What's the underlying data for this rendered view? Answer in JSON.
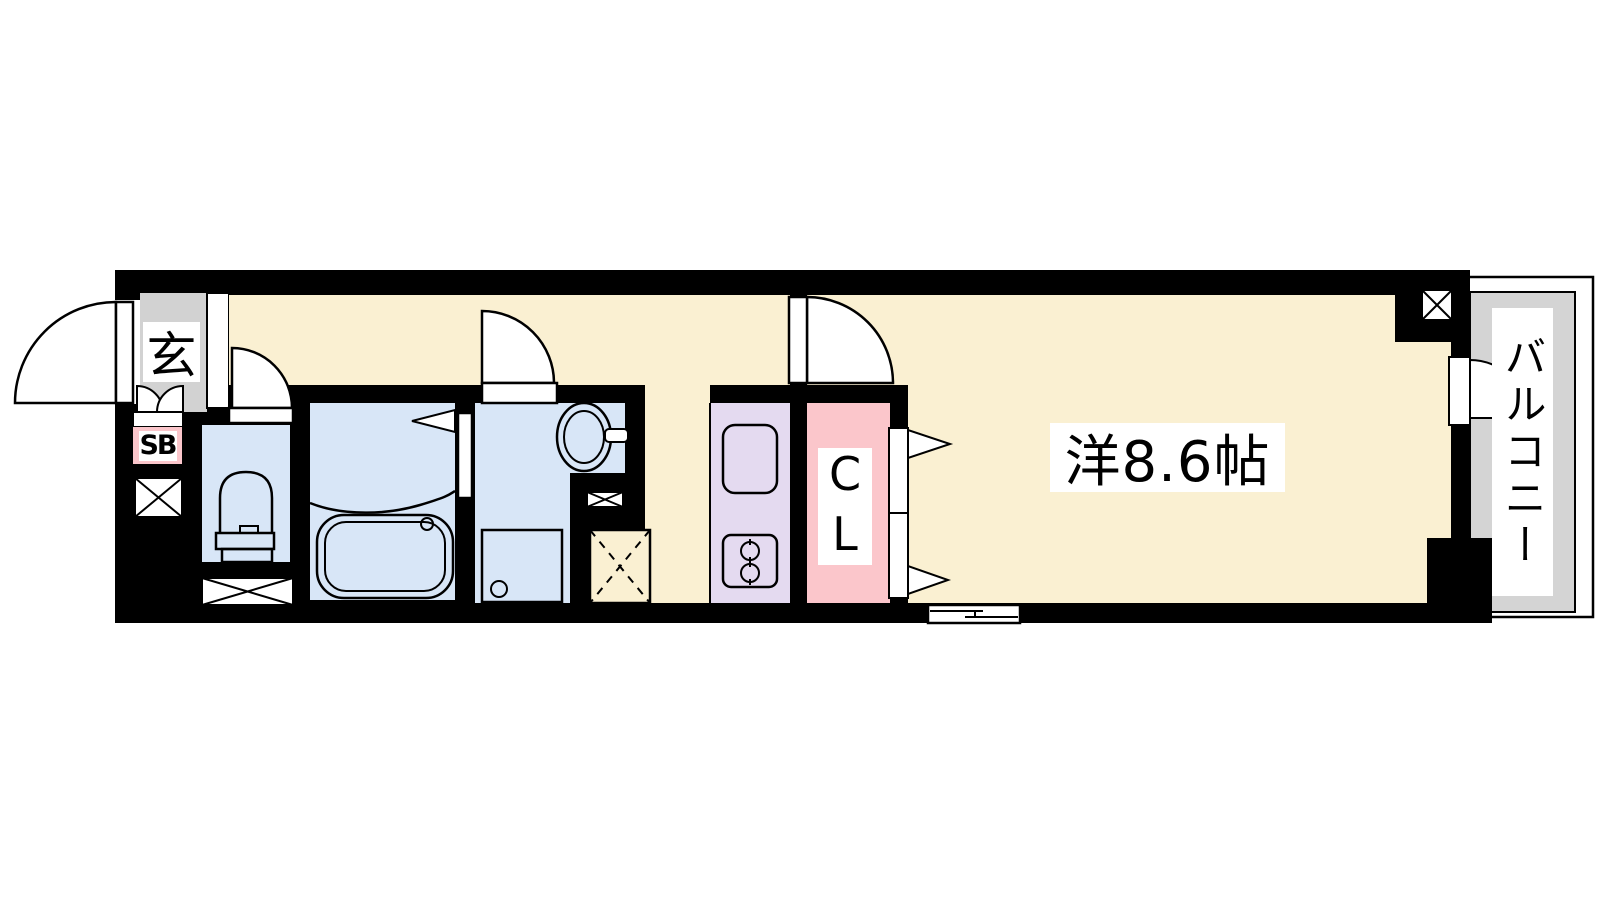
{
  "floorplan": {
    "labels": {
      "entrance": "玄",
      "shoe_box": "SB",
      "closet": "CL",
      "main_room": "洋8.6帖",
      "balcony": "バルコニー"
    },
    "colors": {
      "floor_cream": "#FAF0D2",
      "wet_area_blue": "#D8E6F7",
      "kitchen_purple": "#E4DAF0",
      "closet_pink": "#FBC6CB",
      "entry_gray": "#D2D2D2",
      "balcony_gray": "#D4D4D4",
      "wall_black": "#000000"
    },
    "symbols": {
      "pipe_shaft": "crossed-box",
      "refrigerator_space": "dashed-crossed-box",
      "sliding_window": "offset-double-line",
      "hinged_door": "quarter-circle-arc",
      "folding_door": "triangle-arrow"
    }
  }
}
